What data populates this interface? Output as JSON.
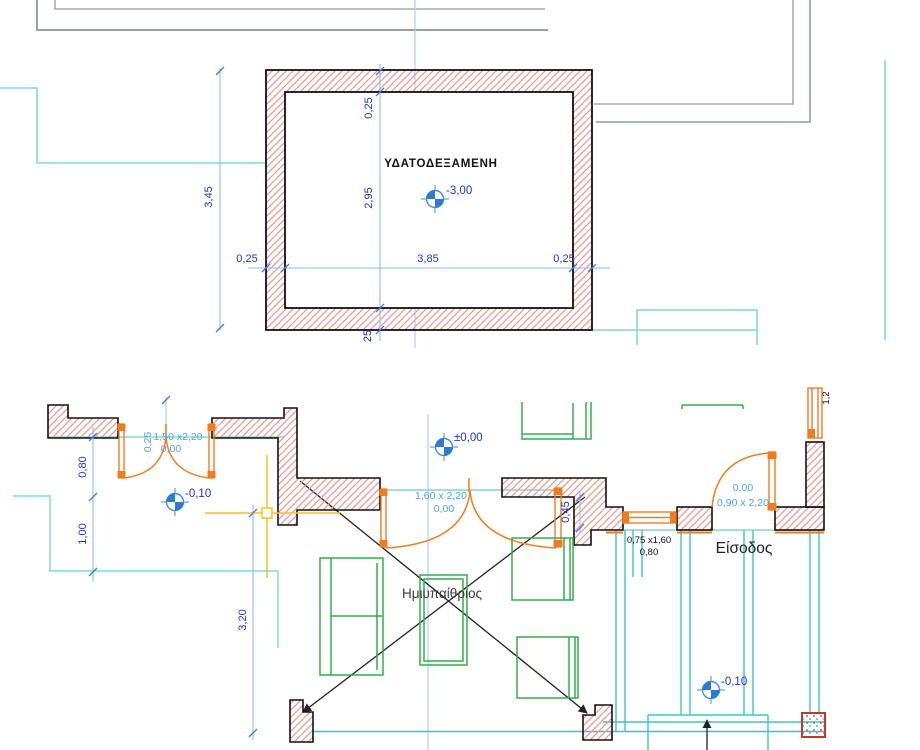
{
  "colors": {
    "wall_hatch": "#f2968c",
    "wall_outline": "#111111",
    "joinery_orange": "#f07c20",
    "furniture_green": "#33ad4d",
    "teal_light": "#7edccb",
    "cyan_steps": "#38c8c0",
    "roof_gray": "#ababab",
    "axis_blue": "#a9d2ef",
    "dimension_blue": "#2233cc",
    "spec_blue": "#4da3f5",
    "guide_yellow": "#f7c21e",
    "column_red": "#c0392b"
  },
  "tank": {
    "label": "ΥΔΑΤΟΔΕΞΑΜΕΝΗ",
    "level": "-3,00",
    "dim_wall_top": "0,25",
    "dim_inner": "2,95",
    "dim_bottom_wall": "25",
    "dim_left_wall": "0,25",
    "dim_width": "3,85",
    "dim_right_wall": "0,25",
    "dim_outer_height": "3,45"
  },
  "plan": {
    "room_center": "Ημιυπαίθριος",
    "room_entrance": "Είσοδος",
    "level_zero": "±0,00",
    "level_minus10_left": "-0,10",
    "level_minus10_right": "-0,10",
    "dim_left_a": "0,80",
    "dim_left_b": "1,00",
    "dim_left_c": "3,20",
    "dim_step": "0,45",
    "door_left": {
      "tag": "0,25",
      "size": "1,50 x2,20",
      "sill": "0,00"
    },
    "door_center": {
      "size": "1,60 x 2,20",
      "sill": "0,00"
    },
    "door_entrance": {
      "sill": "0,00",
      "size": "0,90 x 2,20"
    },
    "window_entrance": {
      "size": "0,75 x1,60",
      "sill": "0,80"
    },
    "window_side": {
      "size": "1,2"
    }
  }
}
